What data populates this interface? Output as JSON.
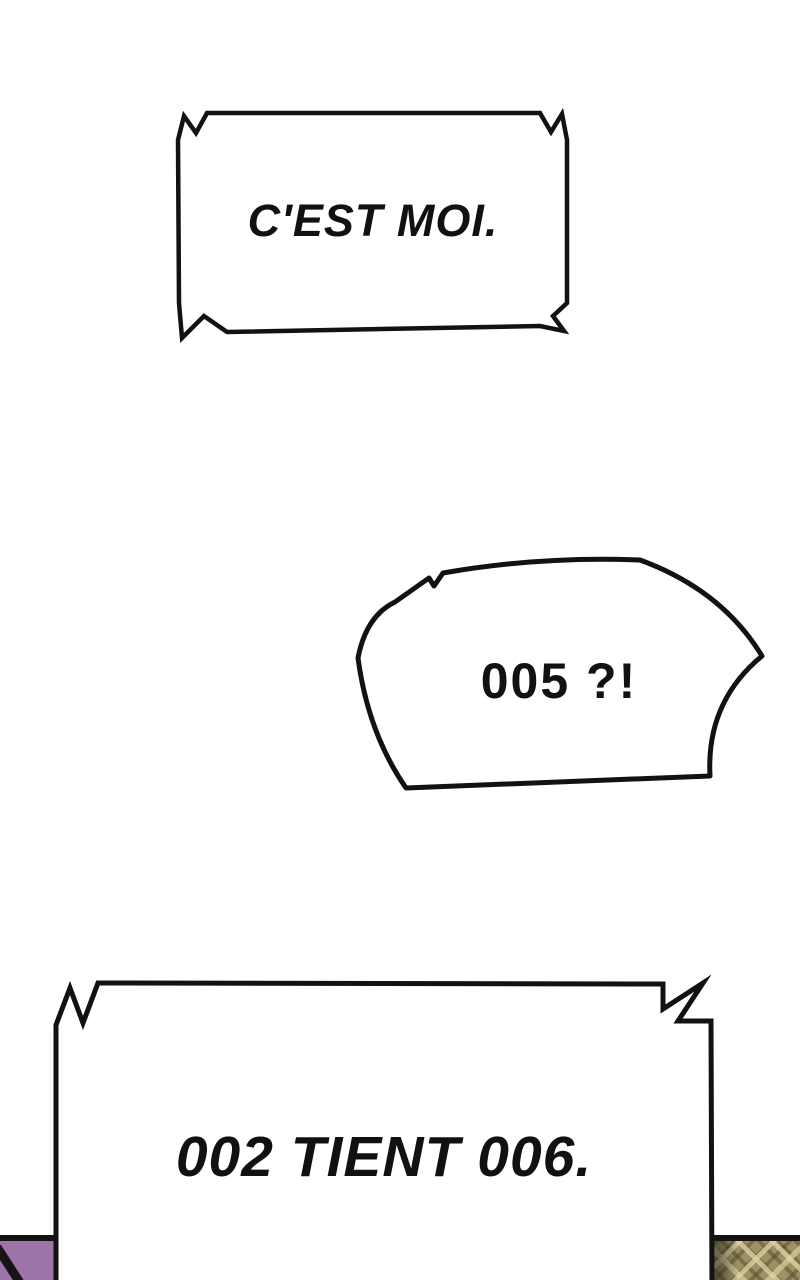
{
  "page": {
    "kind": "comic-page",
    "background_color": "#ffffff",
    "ink_color": "#121212"
  },
  "captions": {
    "top_box": {
      "text": "C'EST MOI."
    },
    "shout_bubble": {
      "text": "005 ?!"
    },
    "bottom_box": {
      "text": "002 TIENT 006."
    }
  },
  "panel_fragments": {
    "bottom_left": {
      "color": "#9d74a9",
      "detail": "black diagonal stroke"
    },
    "bottom_right": {
      "base_color": "#9e9166",
      "light_color": "#dfd5a4",
      "dark_color": "#4d442a",
      "pattern": "argyle-plaid fabric"
    }
  }
}
